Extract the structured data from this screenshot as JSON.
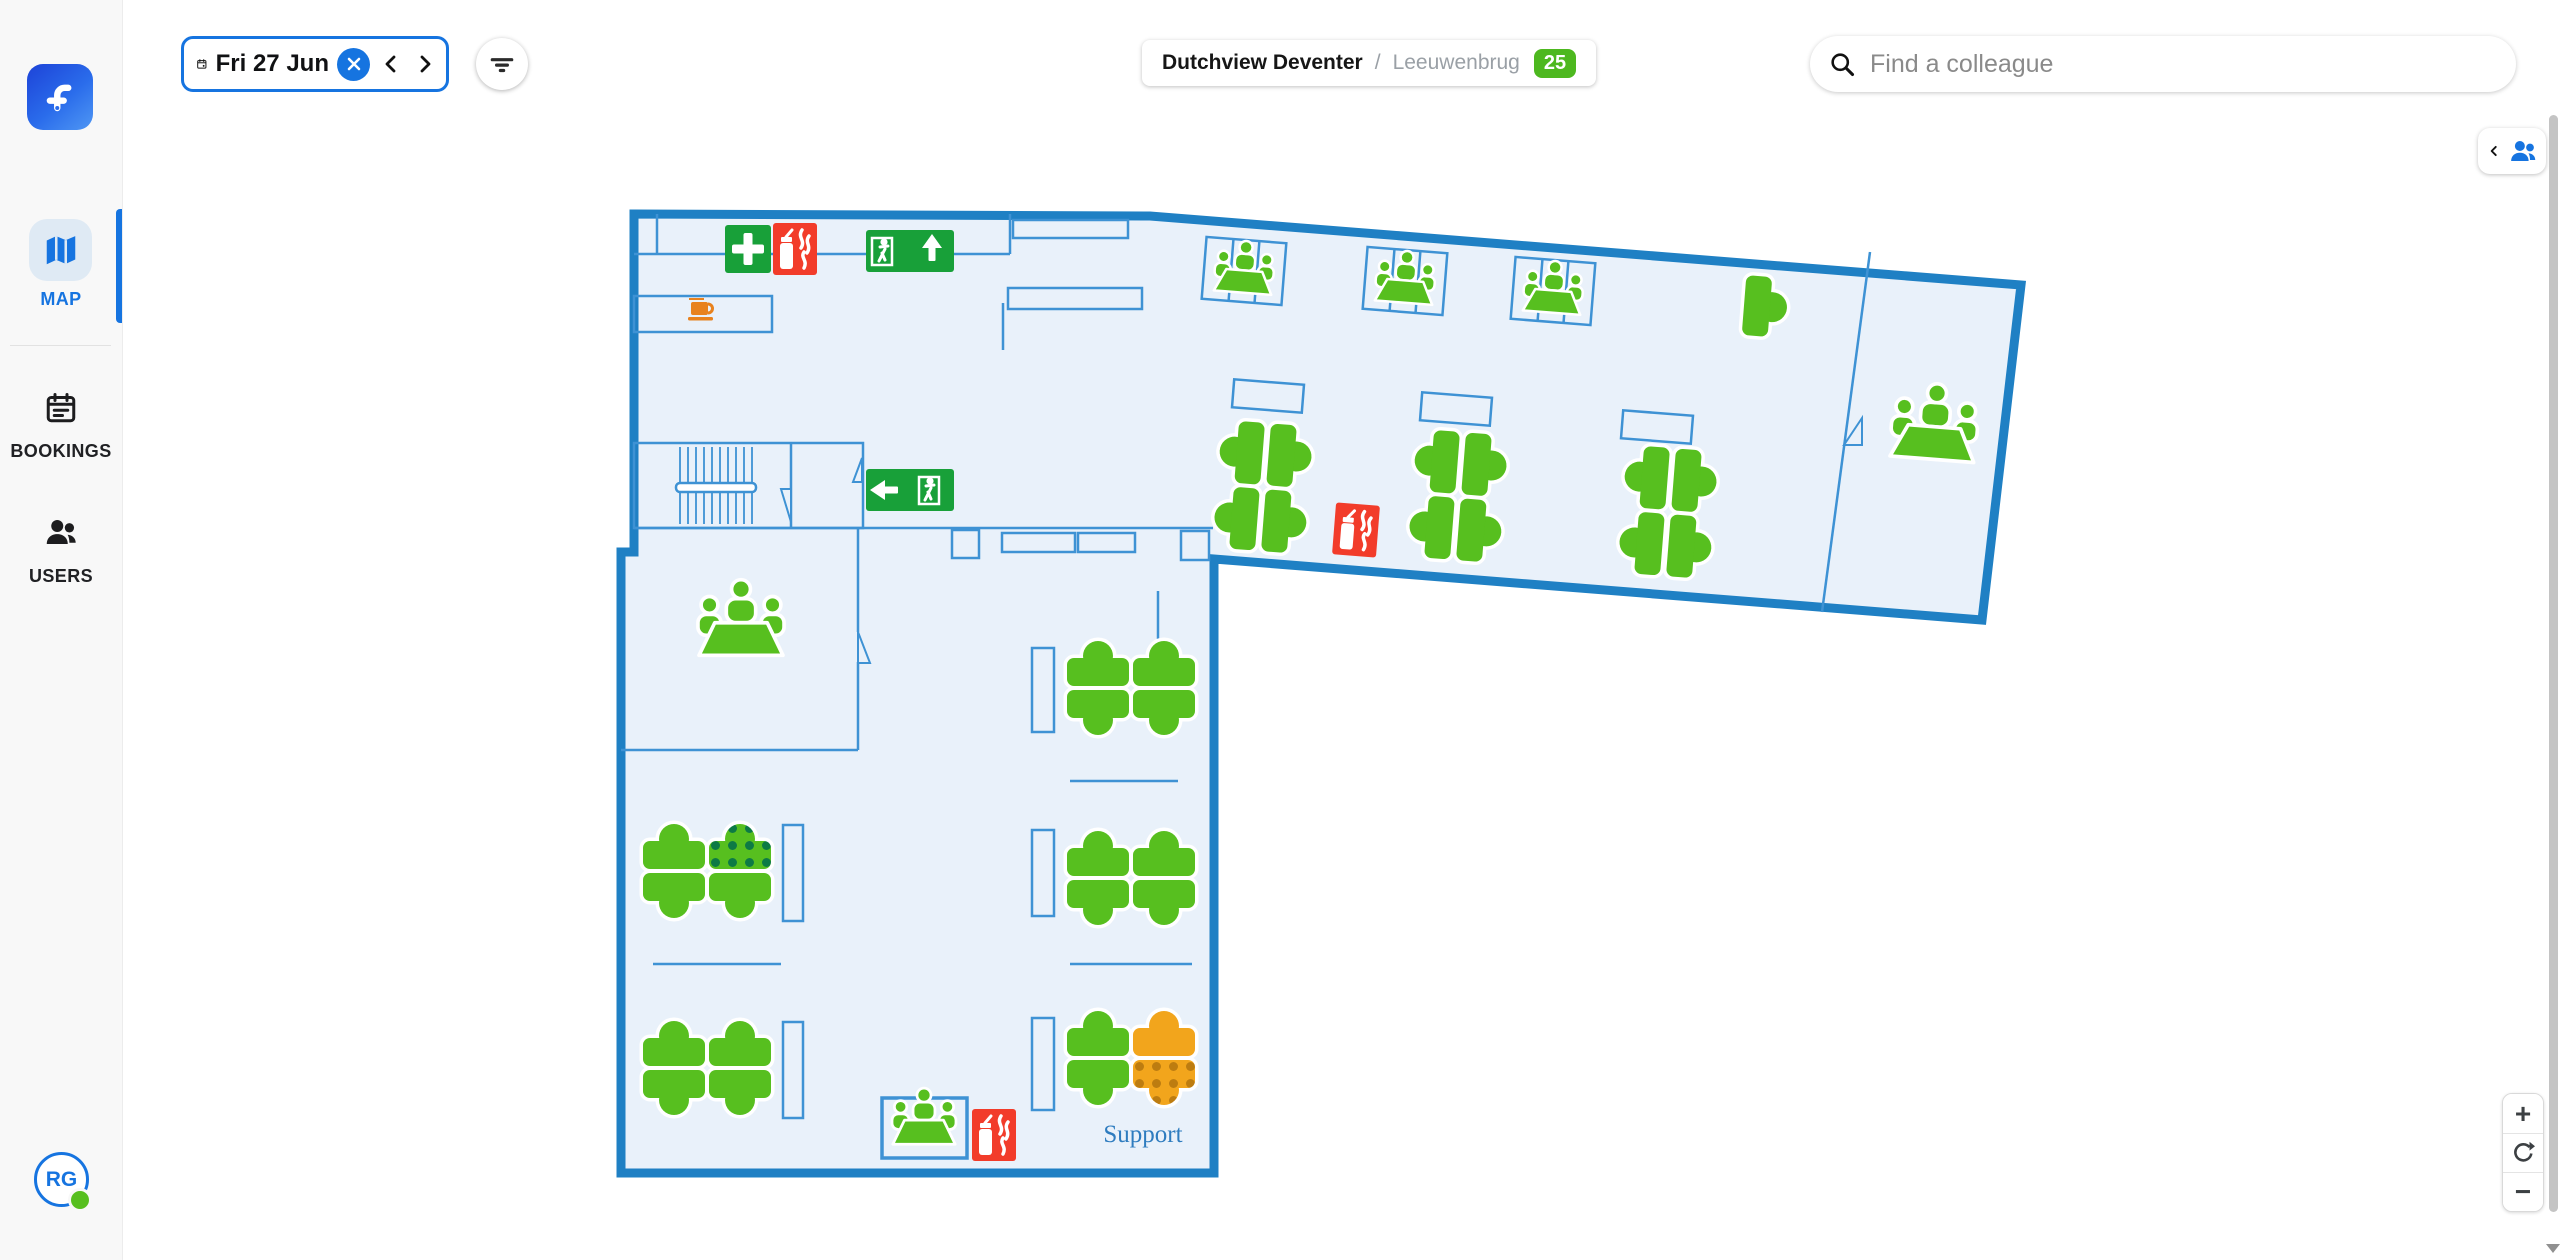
{
  "theme": {
    "accent": "#1674e0",
    "wall": "#1f80c4",
    "wall-thin": "#3e92d4",
    "floor": "#e9f1fa",
    "desk-green": "#57bf1f",
    "dot-green": "#0d7a45",
    "desk-orange": "#f2a51c",
    "dot-orange": "#bd7c10",
    "sign-red": "#f23c2a",
    "sign-green": "#18a039",
    "coffee": "#e8821e",
    "badge-green": "#4db81f",
    "map-label": "#2e7cbf"
  },
  "sidebar": {
    "items": [
      {
        "label": "MAP",
        "icon": "map-icon",
        "active": true
      },
      {
        "label": "BOOKINGS",
        "icon": "bookings-icon",
        "active": false
      },
      {
        "label": "USERS",
        "icon": "users-icon",
        "active": false
      }
    ],
    "avatar_initials": "RG",
    "presence_status": "available"
  },
  "topbar": {
    "date_label": "Fri 27 Jun",
    "breadcrumb": {
      "site": "Dutchview Deventer",
      "separator": "/",
      "floor": "Leeuwenbrug",
      "badge_count": "25"
    },
    "search_placeholder": "Find a colleague"
  },
  "zoom_controls": {
    "zoom_in_label": "+",
    "zoom_out_label": "−"
  },
  "map": {
    "support_label": "Support",
    "desk_status_legend": {
      "available": "green solid",
      "booked": "green with dark-green dots",
      "occupied": "orange solid",
      "occupied-booked": "orange with dark-orange dots"
    },
    "desk_clusters": [
      {
        "x": 1263,
        "y": 487,
        "rot": 4.5,
        "o": "v",
        "desks": [
          "available",
          "available",
          "available",
          "available"
        ]
      },
      {
        "x": 1458,
        "y": 496,
        "rot": 4.5,
        "o": "v",
        "desks": [
          "available",
          "available",
          "available",
          "available"
        ]
      },
      {
        "x": 1668,
        "y": 512,
        "rot": 4.5,
        "o": "v",
        "desks": [
          "available",
          "available",
          "available",
          "available"
        ]
      },
      {
        "x": 707,
        "y": 871,
        "rot": 0,
        "o": "h",
        "desks": [
          "available",
          "booked",
          "available",
          "available"
        ]
      },
      {
        "x": 707,
        "y": 1068,
        "rot": 0,
        "o": "h",
        "desks": [
          "available",
          "available",
          "available",
          "available"
        ]
      },
      {
        "x": 1131,
        "y": 688,
        "rot": 0,
        "o": "h",
        "desks": [
          "available",
          "available",
          "available",
          "available"
        ]
      },
      {
        "x": 1131,
        "y": 878,
        "rot": 0,
        "o": "h",
        "desks": [
          "available",
          "available",
          "available",
          "available"
        ]
      },
      {
        "x": 1131,
        "y": 1058,
        "rot": 0,
        "o": "h",
        "desks": [
          "available",
          "occupied",
          "available",
          "occupied-booked"
        ]
      },
      {
        "x": 1757,
        "y": 306,
        "rot": 4.5,
        "o": "single",
        "desks": [
          "available"
        ]
      }
    ],
    "meeting_icons": [
      {
        "x": 1244,
        "y": 274,
        "scale": 0.72,
        "rot": 4.5
      },
      {
        "x": 1405,
        "y": 284,
        "scale": 0.72,
        "rot": 4.5
      },
      {
        "x": 1553,
        "y": 294,
        "scale": 0.72,
        "rot": 4.5
      },
      {
        "x": 1934,
        "y": 432,
        "scale": 1.05,
        "rot": 4.5
      },
      {
        "x": 741,
        "y": 628,
        "scale": 1.05,
        "rot": 0
      },
      {
        "x": 924,
        "y": 1124,
        "scale": 0.78,
        "rot": 0
      }
    ],
    "signs": [
      {
        "type": "first-aid",
        "x": 748,
        "y": 249
      },
      {
        "type": "fire-extinguisher",
        "x": 795,
        "y": 249
      },
      {
        "type": "exit-up",
        "x": 910,
        "y": 251
      },
      {
        "type": "exit-left",
        "x": 910,
        "y": 490
      },
      {
        "type": "fire-extinguisher",
        "x": 1356,
        "y": 530,
        "rot": 4.5
      },
      {
        "type": "fire-extinguisher",
        "x": 994,
        "y": 1135
      },
      {
        "type": "coffee",
        "x": 701,
        "y": 311
      }
    ]
  }
}
